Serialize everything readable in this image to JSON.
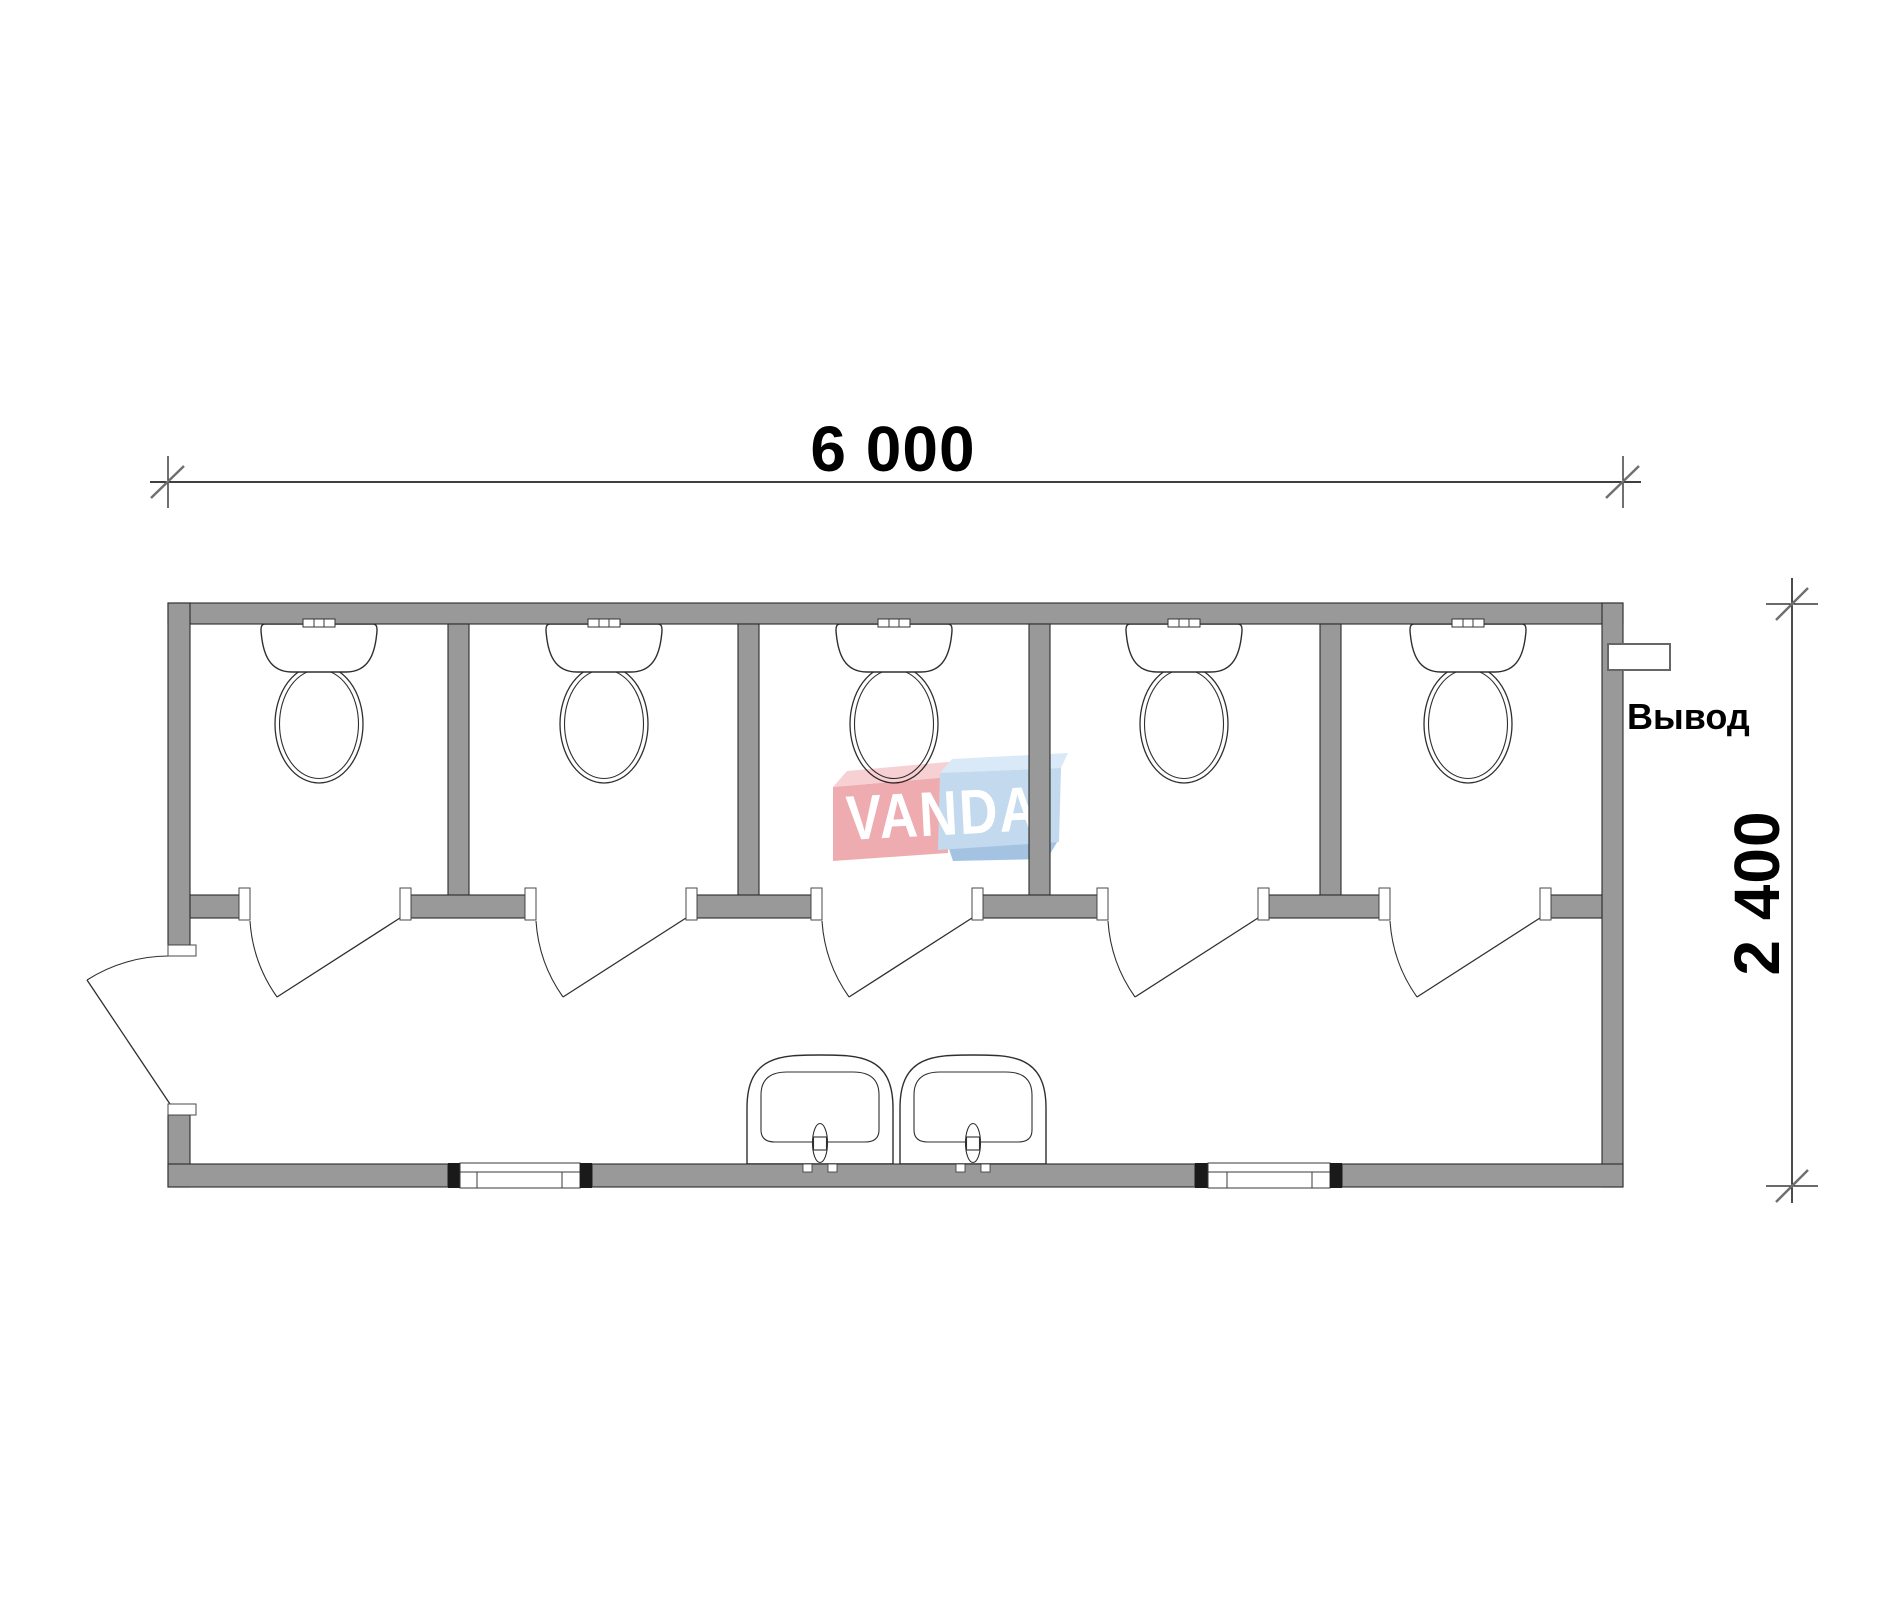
{
  "floorplan": {
    "type": "sanitary-container-plan-view",
    "dimension_width": "6 000",
    "dimension_height": "2 400",
    "outlet_label": "Вывод",
    "watermark_text": "VANDA",
    "counts": {
      "toilet_stalls": 5,
      "toilets": 5,
      "sinks": 2,
      "stall_doors": 5,
      "entrance_doors": 1,
      "windows": 2,
      "outlets": 1
    },
    "colors": {
      "wall": "#999999",
      "outline": "#2b2b2b",
      "dim_slash": "#6f6f6f",
      "watermark_red": "#eeacb1",
      "watermark_red_light": "#f7d0d3",
      "watermark_blue": "#c3d9ee",
      "watermark_blue_light": "#d9e9f8",
      "watermark_blue_dark": "#a4c3e2",
      "background": "#ffffff"
    }
  }
}
